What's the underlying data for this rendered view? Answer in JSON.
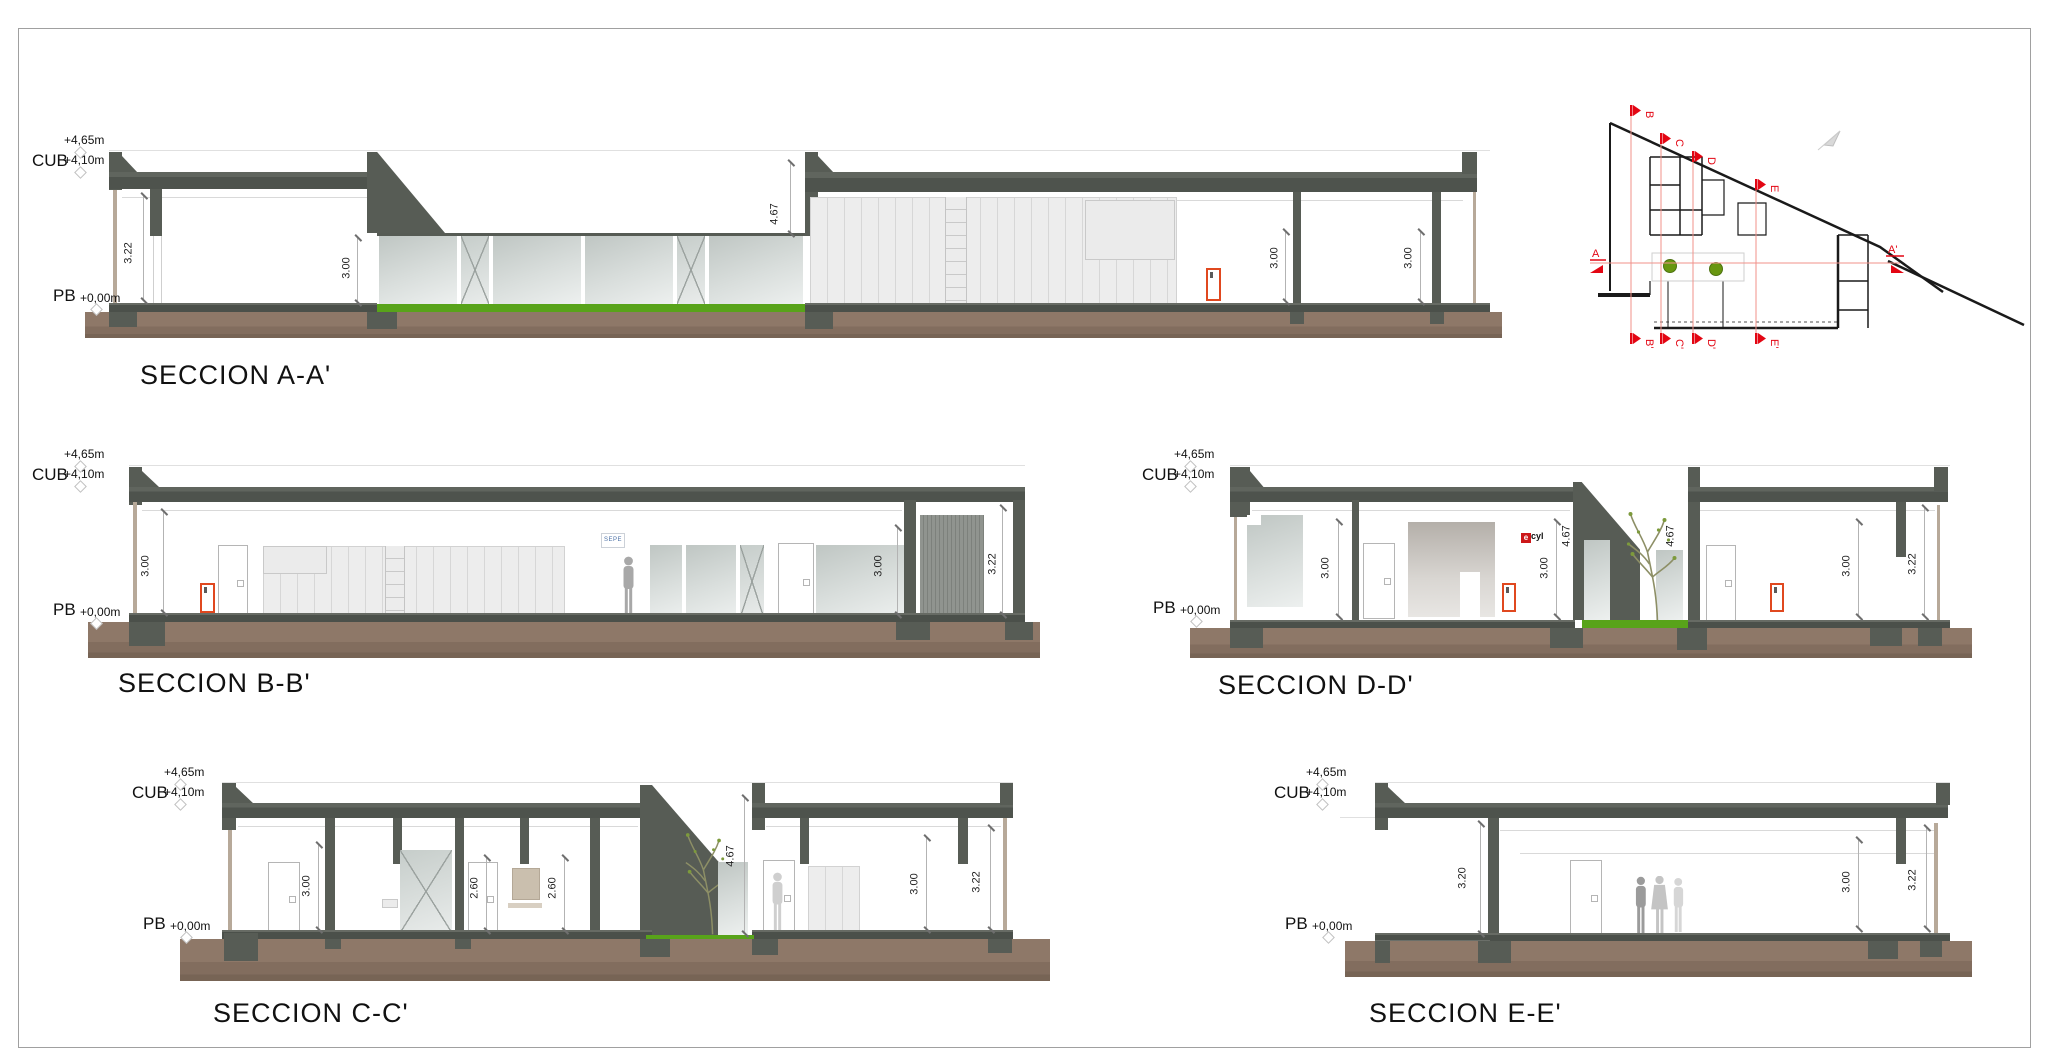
{
  "levels": {
    "l465": "+4,65m",
    "cub": "CUB",
    "l410": "+4,10m",
    "pb": "PB",
    "l000": "+0,00m"
  },
  "sections": {
    "a": {
      "title": "SECCION A-A'",
      "dims": [
        "3.22",
        "3.00",
        "4.67",
        "3.00",
        "3.00"
      ]
    },
    "b": {
      "title": "SECCION B-B'",
      "dims": [
        "3.00",
        "3.00",
        "3.22"
      ]
    },
    "c": {
      "title": "SECCION C-C'",
      "dims": [
        "3.00",
        "2.60",
        "2.60",
        "4.67",
        "3.00",
        "3.22"
      ]
    },
    "d": {
      "title": "SECCION D-D'",
      "dims": [
        "3.00",
        "3.00",
        "4.67",
        "4.67",
        "3.00",
        "3.22"
      ]
    },
    "e": {
      "title": "SECCION E-E'",
      "dims": [
        "3.20",
        "3.00",
        "3.22"
      ]
    }
  },
  "signs": {
    "sepe": "SEPE",
    "ecyl_e": "e",
    "ecyl_rest": "cyl"
  },
  "keyplan": {
    "a": "A",
    "a_prime": "A'",
    "top": [
      "B",
      "C",
      "D",
      "E"
    ],
    "bottom": [
      "B'",
      "C'",
      "D'",
      "E'"
    ]
  },
  "colors": {
    "accent_red": "#e30613",
    "door_red": "#e0481f",
    "grass_green": "#58a31a",
    "wall_dark": "#575c55",
    "ground_brown": "#87705f"
  }
}
